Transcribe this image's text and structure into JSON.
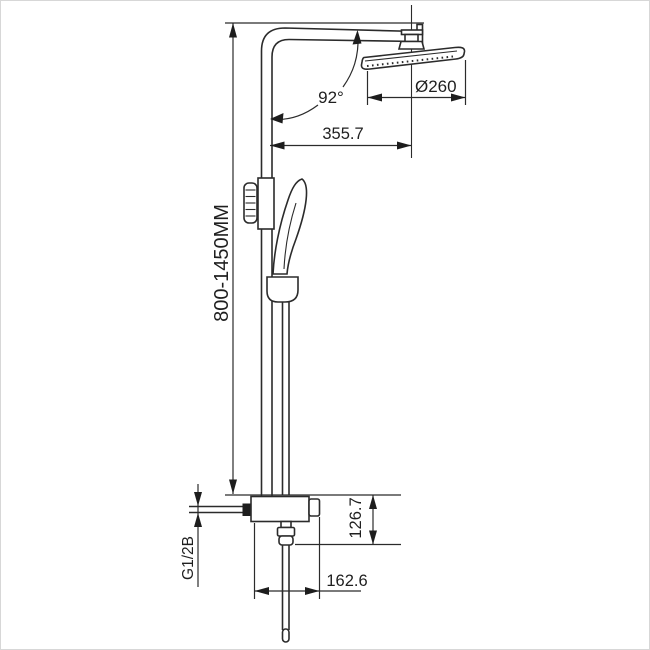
{
  "drawing": {
    "type": "technical-dimension-drawing",
    "subject": "thermostatic shower column with overhead rain shower, hand shower and bottom mixer valve",
    "line_color": "#2b2b2b",
    "background_color": "#ffffff",
    "labels": {
      "height_range": "800-1450MM",
      "arm_angle": "92°",
      "head_diameter": "Ø260",
      "arm_reach": "355.7",
      "valve_height": "126.7",
      "valve_depth": "162.6",
      "inlet_thread": "G1/2B"
    }
  }
}
